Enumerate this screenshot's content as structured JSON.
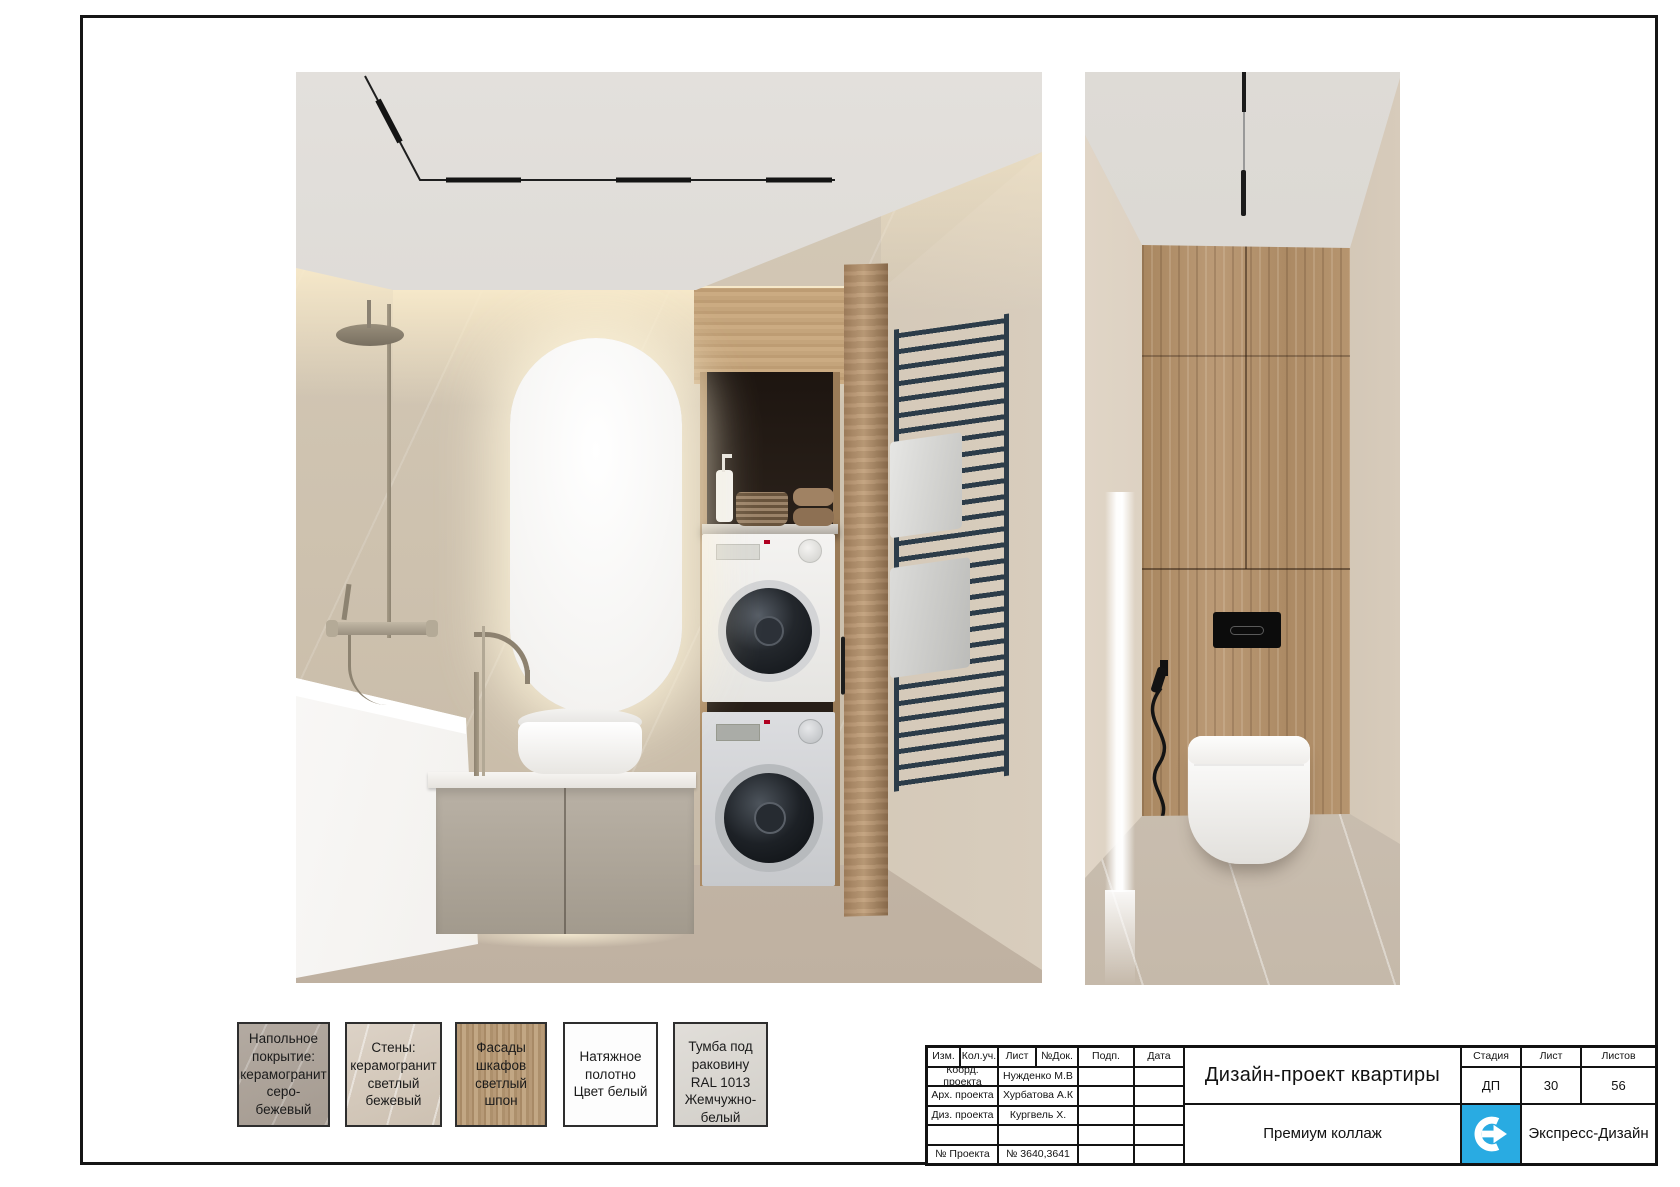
{
  "colors": {
    "logo_blue": "#29ABE2",
    "frame": "#151515"
  },
  "materials": [
    {
      "texture": "gray-beige-stone",
      "label": "Напольное\nпокрытие:\nкерамогранит\nсеро-бежевый"
    },
    {
      "texture": "light-beige-stone",
      "label": "Стены:\nкерамогранит\nсветлый\nбежевый"
    },
    {
      "texture": "light-wood-veneer",
      "label": "Фасады шкафов\nсветлый шпон"
    },
    {
      "texture": "white-stretch-ceiling",
      "label": "Натяжное\nполотно\nЦвет белый"
    },
    {
      "texture": "pearl-white",
      "label": "Тумба под\nраковину\nRAL 1013\nЖемчужно-\nбелый"
    }
  ],
  "stamp": {
    "header": [
      "Изм.",
      "Кол.уч.",
      "Лист",
      "№Док.",
      "Подп.",
      "Дата"
    ],
    "rows": [
      {
        "label": "Коорд. проекта",
        "value": "Нужденко М.В"
      },
      {
        "label": "Арх. проекта",
        "value": "Хурбатова А.К"
      },
      {
        "label": "Диз. проекта",
        "value": "Кургвель Х."
      },
      {
        "label": "",
        "value": ""
      },
      {
        "label": "№ Проекта",
        "value": "№ 3640,3641"
      }
    ],
    "project_title": "Дизайн-проект квартиры",
    "sheet_title": "Премиум коллаж",
    "stage_label": "Стадия",
    "stage_value": "ДП",
    "sheet_label": "Лист",
    "sheet_value": "30",
    "sheets_label": "Листов",
    "sheets_value": "56",
    "company": "Экспресс-Дизайн"
  }
}
